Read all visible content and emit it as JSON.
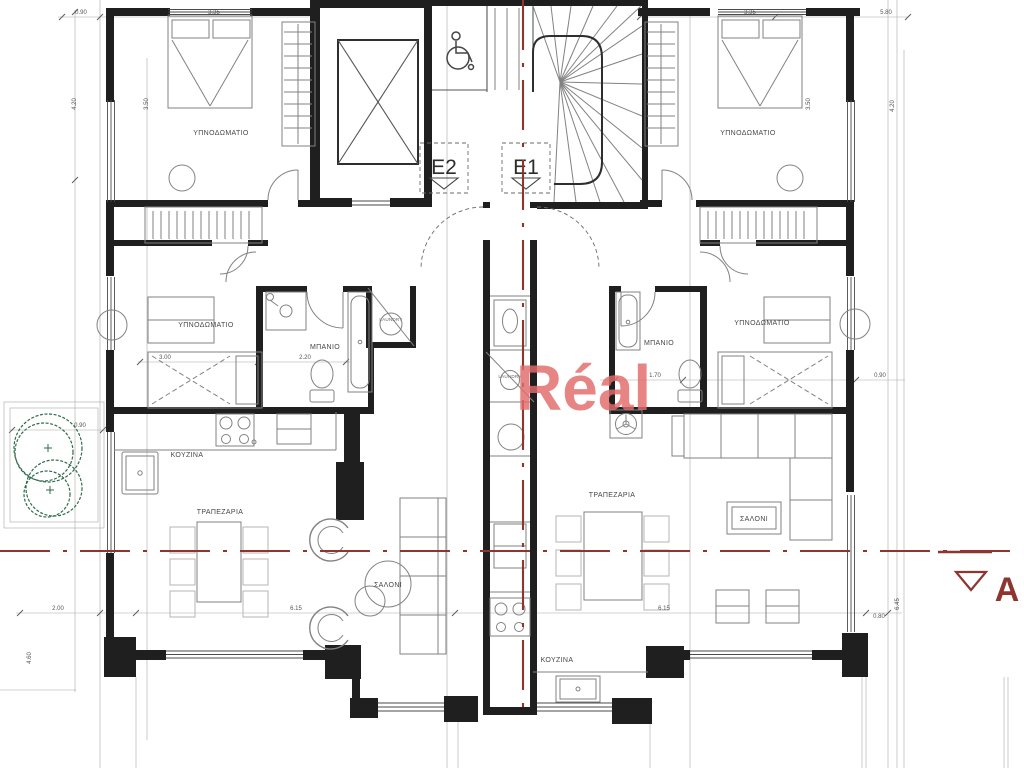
{
  "drawing": {
    "type": "architectural-floor-plan",
    "units": {
      "e2": "E2",
      "e1": "E1"
    },
    "rooms": {
      "left": {
        "bedroom1": "ΥΠΝΟΔΩΜΑΤΙΟ",
        "bedroom2": "ΥΠΝΟΔΩΜΑΤΙΟ",
        "bathroom": "ΜΠΑΝΙΟ",
        "laundry": "LAUNDRY",
        "kitchen": "ΚΟΥΖΙΝΑ",
        "dining": "ΤΡΑΠΕΖΑΡΙΑ",
        "living": "ΣΑΛΟΝΙ"
      },
      "right": {
        "bedroom1": "ΥΠΝΟΔΩΜΑΤΙΟ",
        "bedroom2": "ΥΠΝΟΔΩΜΑΤΙΟ",
        "bathroom": "ΜΠΑΝΙΟ",
        "laundry": "LAUNDRY",
        "kitchen": "ΚΟΥΖΙΝΑ",
        "dining": "ΤΡΑΠΕΖΑΡΙΑ",
        "living": "ΣΑΛΟΝΙ"
      }
    },
    "shaft": {
      "laundry": "LAUNDRY"
    },
    "section_marker": {
      "label": "A"
    },
    "watermark": {
      "text": "Réal",
      "color": "#e26b6b"
    },
    "dimensions": {
      "top_left_offset": "0.90",
      "top_left_width": "3.35",
      "top_right_width": "3.35",
      "top_right_total": "5.80",
      "left_depth": "4.20",
      "left_bed": "3.50",
      "right_depth": "4.20",
      "right_bed": "3.50",
      "mid_left_room": "3.00",
      "mid_left_bath": "2.20",
      "mid_right_bath": "1.70",
      "mid_right_offset": "0.90",
      "bottom_terrace": "2.00",
      "bottom_left_width": "6.15",
      "bottom_right_width": "6.15",
      "bottom_right_offset": "0.80",
      "right_height": "6.45",
      "left_height": "4.60",
      "tree_offset": "0.90"
    },
    "colors": {
      "wall": "#1f1f1f",
      "line": "#6e6e6e",
      "furniture": "#828282",
      "light_furniture": "#b5b5b5",
      "section_line": "#8e3530",
      "tree": "#2f6b4b",
      "watermark": "#e26b6b"
    }
  }
}
